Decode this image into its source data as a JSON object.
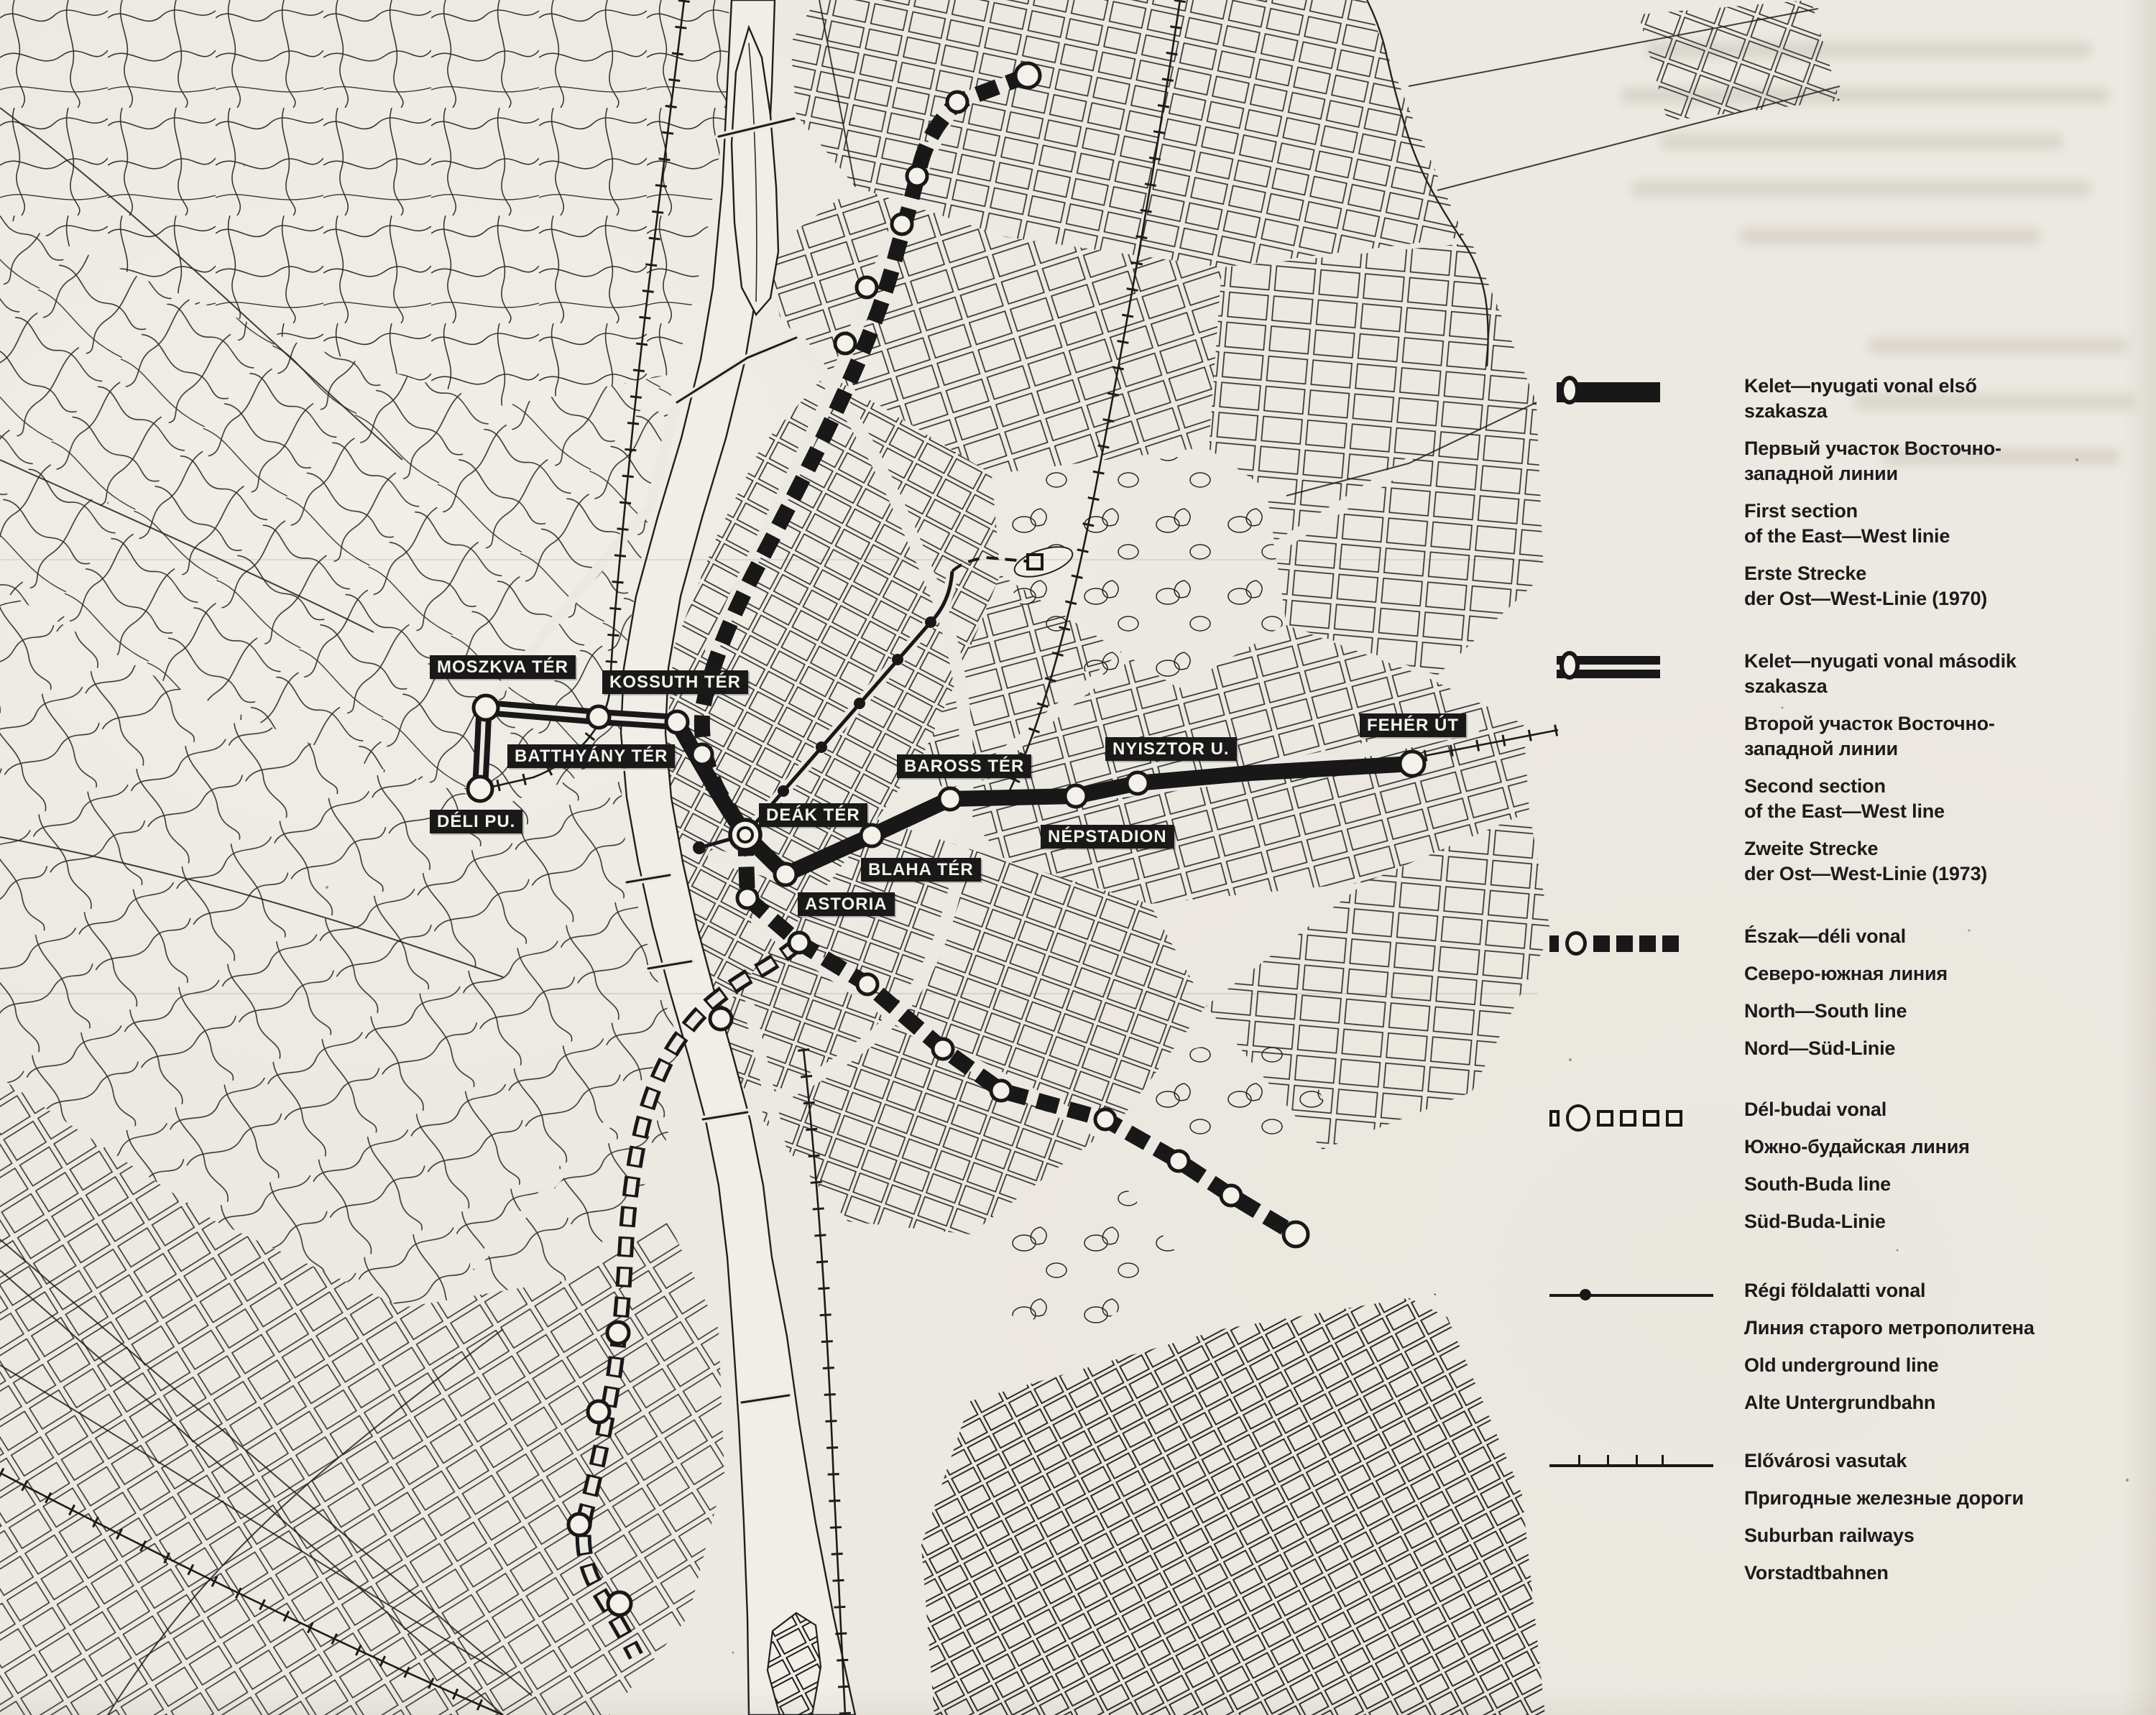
{
  "colors": {
    "paper": "#ECE9E2",
    "ink": "#1B1B1B"
  },
  "map": {
    "stations": [
      {
        "id": "moszkva-ter",
        "label": "MOSZKVA TÉR"
      },
      {
        "id": "kossuth-ter",
        "label": "KOSSUTH TÉR"
      },
      {
        "id": "batthyany-ter",
        "label": "BATTHYÁNY TÉR"
      },
      {
        "id": "deli-pu",
        "label": "DÉLI PU."
      },
      {
        "id": "deak-ter",
        "label": "DEÁK TÉR"
      },
      {
        "id": "astoria",
        "label": "ASTORIA"
      },
      {
        "id": "blaha-ter",
        "label": "BLAHA TÉR"
      },
      {
        "id": "baross-ter",
        "label": "BAROSS TÉR"
      },
      {
        "id": "nepstadion",
        "label": "NÉPSTADION"
      },
      {
        "id": "nyisztor-u",
        "label": "NYISZTOR U."
      },
      {
        "id": "feher-ut",
        "label": "FEHÉR ÚT"
      }
    ]
  },
  "legend": {
    "entries": [
      {
        "symbol": "first-section-line",
        "hu": "Kelet—nyugati vonal első\nszakasza",
        "ru": "Первый участок Восточно-\nзападной линии",
        "en": "First section\nof the East—West linie",
        "de": "Erste Strecke\nder Ost—West-Linie (1970)"
      },
      {
        "symbol": "second-section-line",
        "hu": "Kelet—nyugati vonal második\nszakasza",
        "ru": "Второй участок Восточно-\nзападной линии",
        "en": "Second section\nof the East—West line",
        "de": "Zweite Strecke\nder Ost—West-Linie (1973)"
      },
      {
        "symbol": "north-south-line",
        "hu": "Észak—déli vonal",
        "ru": "Северо-южная линия",
        "en": "North—South line",
        "de": "Nord—Süd-Linie"
      },
      {
        "symbol": "south-buda-line",
        "hu": "Dél-budai vonal",
        "ru": "Южно-будайская линия",
        "en": "South-Buda line",
        "de": "Süd-Buda-Linie"
      },
      {
        "symbol": "old-underground-line",
        "hu": "Régi földalatti vonal",
        "ru": "Линия старого метрополитена",
        "en": "Old underground line",
        "de": "Alte Untergrundbahn"
      },
      {
        "symbol": "suburban-railway-line",
        "hu": "Elővárosi vasutak",
        "ru": "Пригодные железные дороги",
        "en": "Suburban railways",
        "de": "Vorstadtbahnen"
      }
    ]
  }
}
